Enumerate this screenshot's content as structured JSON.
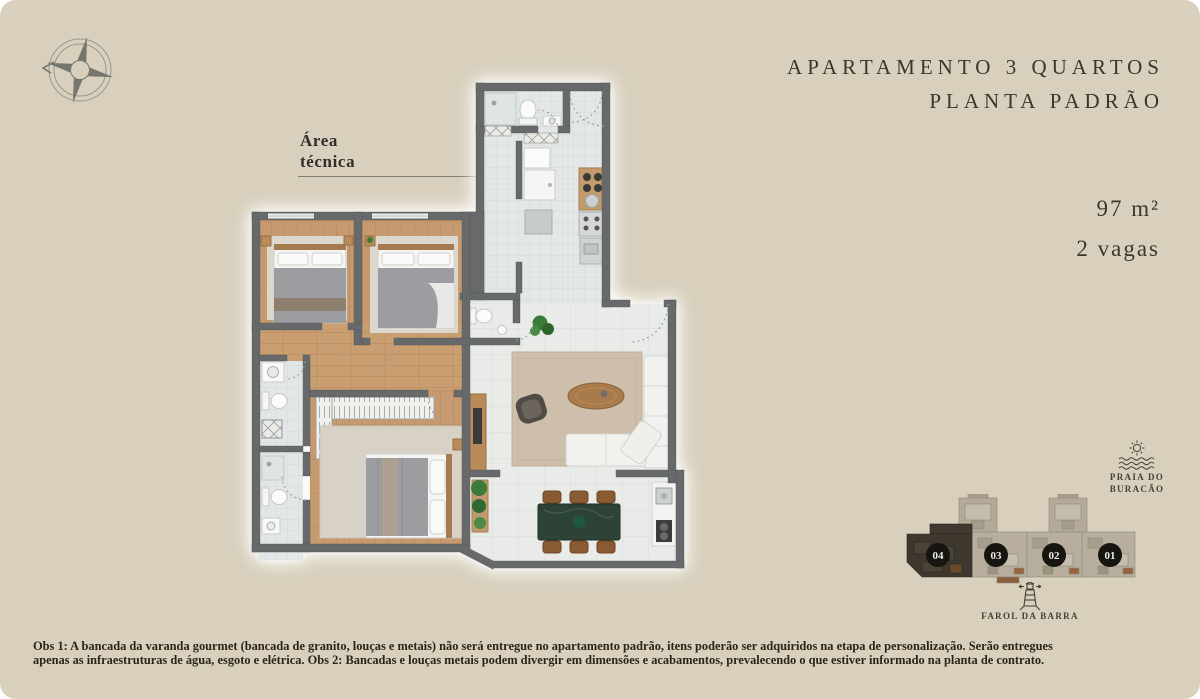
{
  "page": {
    "background": "#d8d0bd",
    "ink": "#38362d"
  },
  "header": {
    "title_line1": "APARTAMENTO 3 QUARTOS",
    "title_line2": "PLANTA PADRÃO"
  },
  "specs": {
    "area": "97 m²",
    "parking": "2 vagas"
  },
  "plan": {
    "annotation_line1": "Área",
    "annotation_line2": "técnica"
  },
  "locator": {
    "beach_label_line1": "PRAIA DO",
    "beach_label_line2": "BURACÃO",
    "landmark_label": "FAROL DA BARRA",
    "units": [
      {
        "label": "04"
      },
      {
        "label": "03"
      },
      {
        "label": "02"
      },
      {
        "label": "01"
      }
    ]
  },
  "footnote": {
    "line1": "Obs 1: A bancada da varanda gourmet (bancada de granito, louças e metais) não será entregue no apartamento padrão, itens poderão ser adquiridos na etapa de personalização. Serão entregues",
    "line2": "apenas as infraestruturas de água, esgoto e elétrica. Obs 2: Bancadas e louças metais podem divergir em dimensões e acabamentos, prevalecendo o que estiver informado na planta de contrato."
  }
}
